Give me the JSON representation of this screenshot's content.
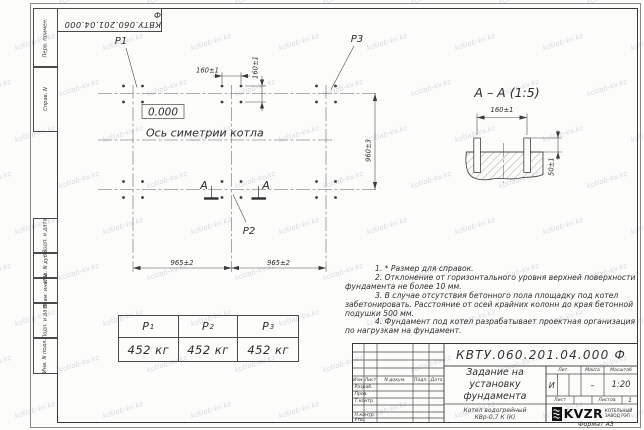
{
  "watermark": {
    "text": "kotlab-kv.kz"
  },
  "frame": {
    "corner_doc_number": "КВТУ.060.201.04.000 Ф",
    "format_label": "Формат А3",
    "side_labels": [
      "Перв. примен.",
      "Справ. N",
      "Подп. и дата",
      "Инв. N дубл.",
      "Взам. инв. N",
      "Подп. и дата",
      "Инв. N подл."
    ]
  },
  "plan": {
    "loads": [
      "P1",
      "P2",
      "P3"
    ],
    "elevation": "0.000",
    "axis_label": "Ось симетрии котла",
    "section_letter": "А",
    "dim_160": "160±1",
    "dim_960": "960±3",
    "dim_965": "965±2"
  },
  "section": {
    "title": "А – А (1:5)",
    "dim_160": "160±1",
    "dim_50": "50±1"
  },
  "load_table": {
    "headers": [
      {
        "base": "P",
        "sub": "1"
      },
      {
        "base": "P",
        "sub": "2"
      },
      {
        "base": "P",
        "sub": "3"
      }
    ],
    "values": [
      "452 кг",
      "452 кг",
      "452 кг"
    ]
  },
  "notes": {
    "lines": [
      "1. * Размер для справок.",
      "2. Отклонение от горизонтального уровня верхней поверхности",
      "фундамента не более 10 мм.",
      "3. В случае отсутствия бетонного пола площадку под котел",
      "забетонировать. Расстояние от осей крайних колонн до края бетонной",
      "подушки 500 мм.",
      "4. Фундамент под котел разрабатывает проектная организация",
      "по нагрузкам на фундамент."
    ]
  },
  "title_block": {
    "doc_number": "КВТУ.060.201.04.000 Ф",
    "title_lines": [
      "Задание на",
      "установку",
      "фундамента"
    ],
    "object_lines": [
      "Котел водогрейный",
      "КВр-0,7 К (К)"
    ],
    "rev_headers": {
      "izm": "Изм.",
      "list": "Лист",
      "doc": "N докум.",
      "sign": "Подп.",
      "date": "Дата"
    },
    "row_labels": [
      "Разраб.",
      "Пров.",
      "Т.контр.",
      "Н.контр.",
      "Утв."
    ],
    "lit_header": "Лит.",
    "mass_header": "Масса",
    "scale_header": "Масштаб",
    "lit_value": "И",
    "mass_value": "–",
    "scale_value": "1:20",
    "sheet_header": "Лист",
    "sheets_header": "Листов",
    "sheets_value": "1",
    "company": {
      "logo_text": "KVZR",
      "name_line1": "КОТЕЛЬНЫЙ",
      "name_line2": "ЗАВОД РЭП"
    }
  }
}
